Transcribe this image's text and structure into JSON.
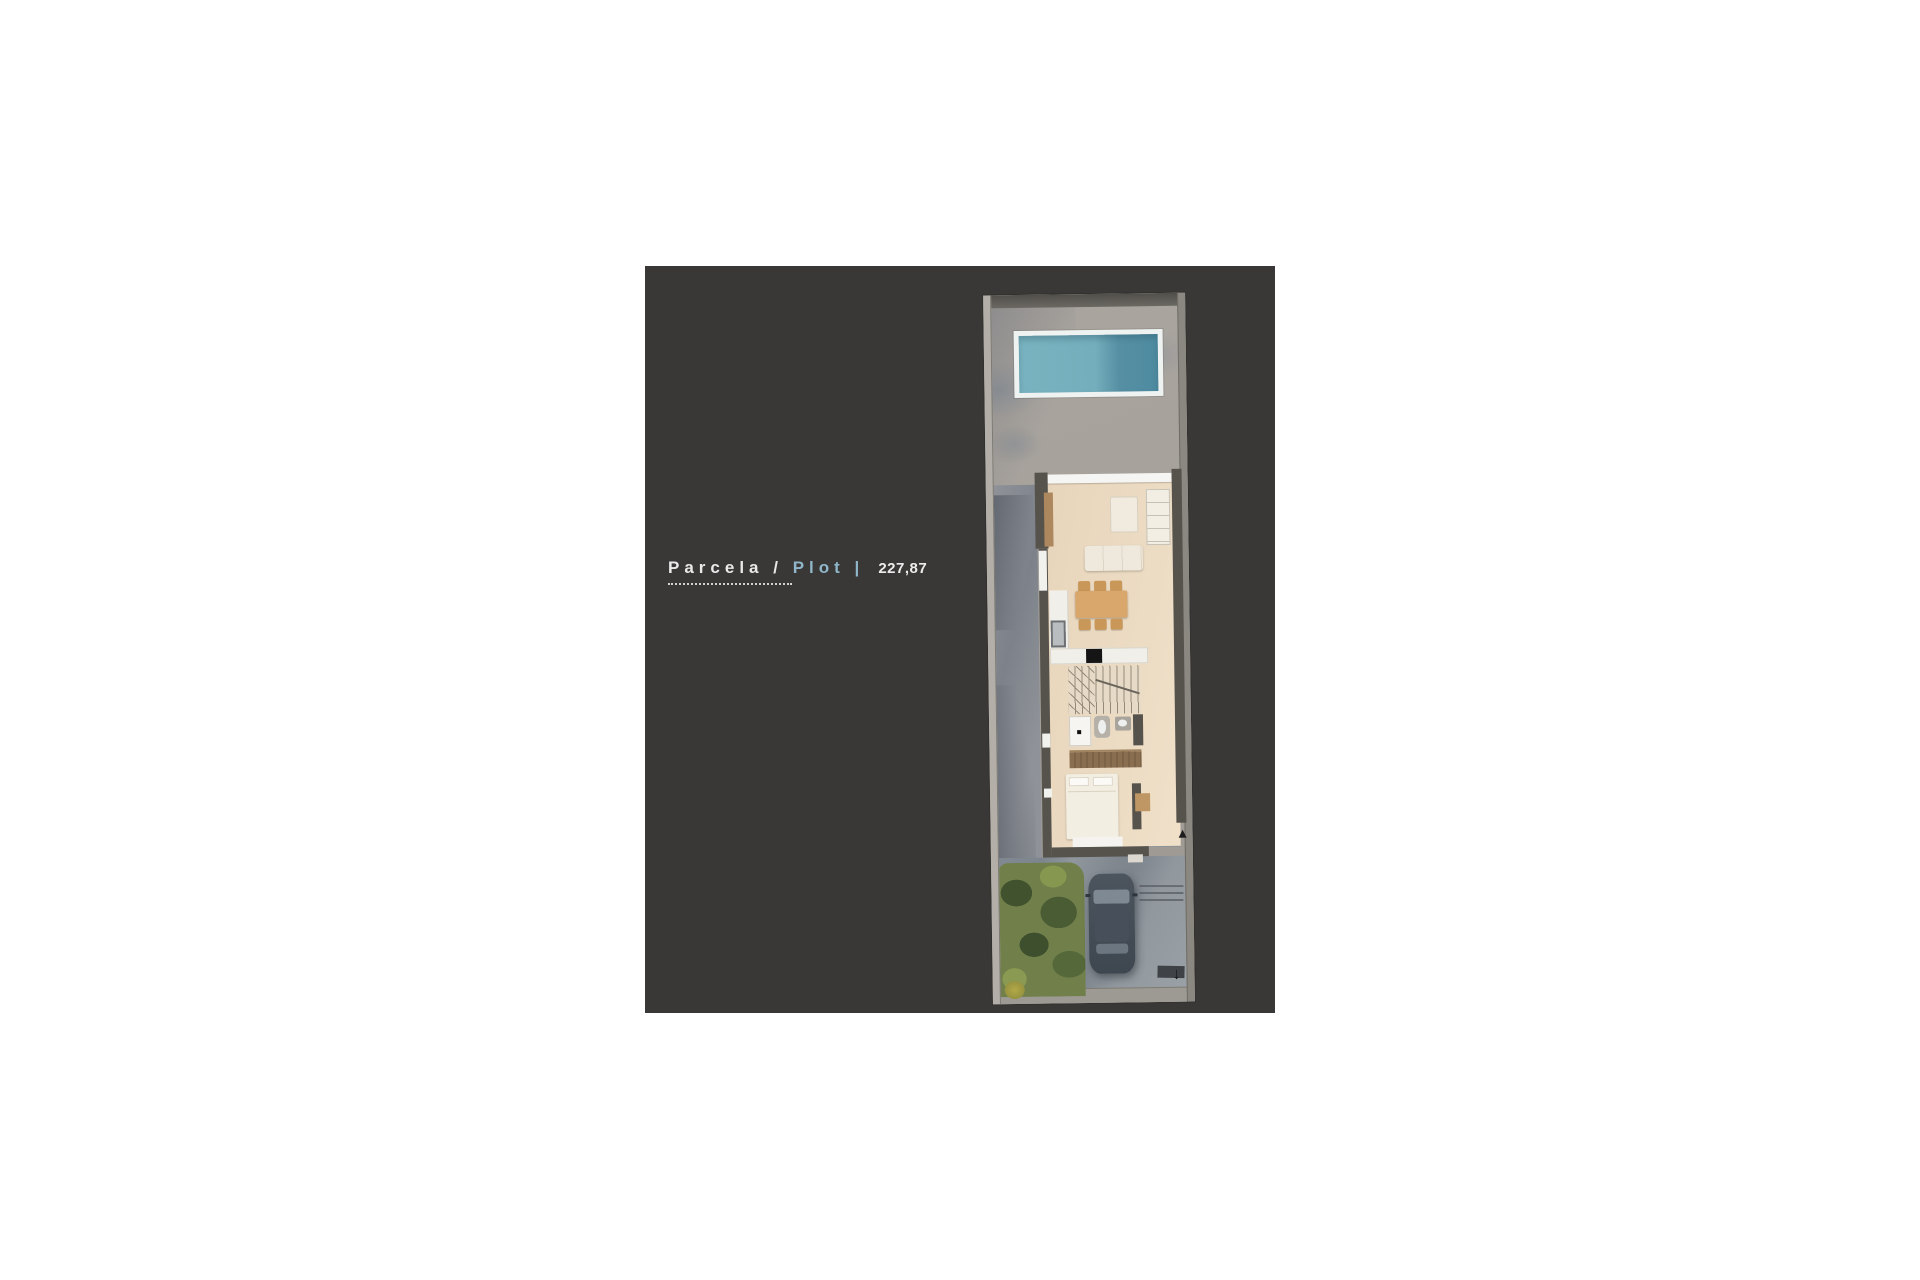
{
  "legend": {
    "parcela_label": "Parcela",
    "slash": "/",
    "plot_label": "Plot",
    "bar": "|",
    "area_value": "227,87"
  },
  "plan": {
    "entrance_arrow_glyph": "↓",
    "features": [
      "swimming-pool",
      "terrace",
      "living-room",
      "sofa",
      "armchair",
      "shelf-unit",
      "dining-table",
      "kitchen-counter",
      "cooktop",
      "sink",
      "staircase",
      "bathroom",
      "wardrobe",
      "bedroom",
      "bed",
      "driveway",
      "car",
      "garden"
    ]
  },
  "colors": {
    "page_bg": "#ffffff",
    "panel_bg": "#3a3836",
    "accent_blue": "#8fb6c9",
    "text_light": "#e9e9e9",
    "pool_water_light": "#79b3c0",
    "pool_water_dark": "#4e8ba0",
    "terrace_gray": "#a8a39d",
    "house_wall": "#56524c",
    "floor_beige": "#ecdbc3",
    "table_wood": "#d9a76c",
    "grass_green": "#71804a",
    "driveway_gray": "#919aa0",
    "car_body": "#424c56"
  }
}
